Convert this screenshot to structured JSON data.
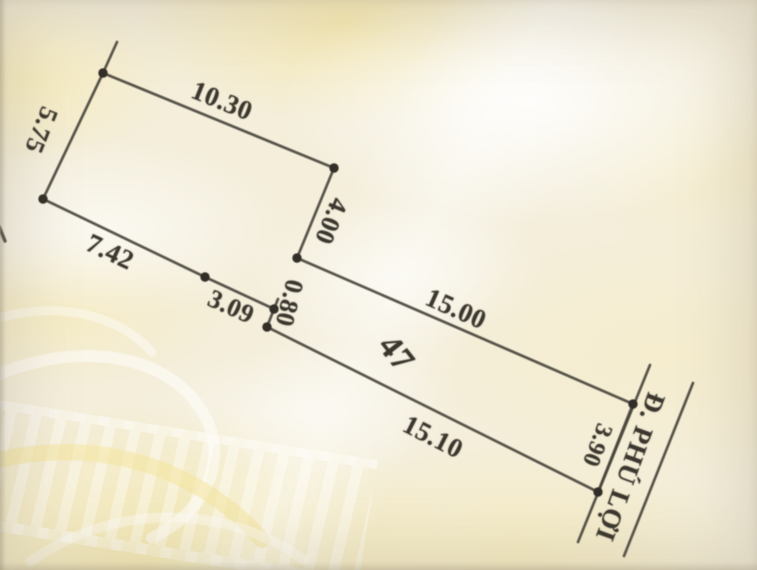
{
  "sketch": {
    "parcel_number": "47",
    "road": {
      "name": "Đ. PHÚ LỢI"
    },
    "dimensions": {
      "top_edge": "10.30",
      "left_edge": "5.75",
      "step_edge": "4.00",
      "rear_lower_edge": "7.42",
      "mid_lower_edge": "3.09",
      "notch_edge": "0.80",
      "front_upper_edge": "15.00",
      "front_lower_edge": "15.10",
      "frontage_edge": "3.90"
    }
  },
  "colors": {
    "paper": "#f4eedb",
    "stain": "#f7e69e",
    "ink": "#4a463e",
    "label_text": "#3b372e"
  }
}
